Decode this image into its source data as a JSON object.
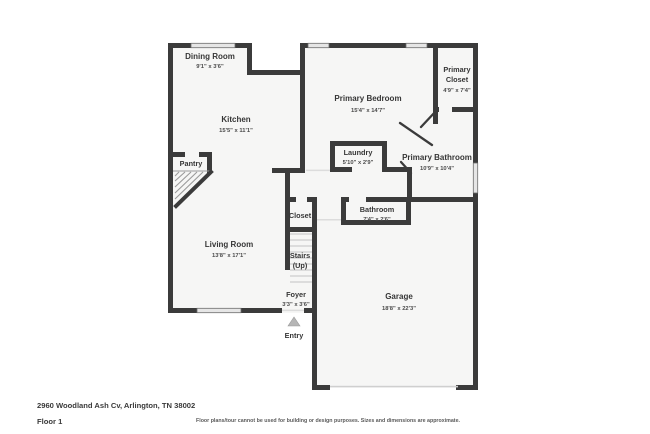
{
  "floor_plan": {
    "address": "2960 Woodland Ash Cv, Arlington, TN 38002",
    "floor_label": "Floor 1",
    "disclaimer": "Floor plans/tour cannot be used for building or design purposes. Sizes and dimensions are approximate.",
    "entry_label": "Entry",
    "colors": {
      "wall": "#3b3b3b",
      "room_fill": "#f6f6f5",
      "window": "#e6e6e6",
      "garage_door": "#cfcfcf",
      "stair_tread": "#c3c3c3",
      "entry_arrow": "#b5b5b5",
      "room_text": "#363636",
      "dims_text": "#4a4a4a",
      "disclaimer_text": "#5a5a5a"
    },
    "rooms": {
      "dining": {
        "name": "Dining Room",
        "dims": "9'1\" x 3'6\""
      },
      "kitchen": {
        "name": "Kitchen",
        "dims": "15'5\" x 11'1\""
      },
      "pantry": {
        "name": "Pantry"
      },
      "living": {
        "name": "Living Room",
        "dims": "13'8\" x 17'1\""
      },
      "closet": {
        "name": "Closet"
      },
      "stairs": {
        "name": "Stairs",
        "sub": "(Up)"
      },
      "foyer": {
        "name": "Foyer",
        "dims": "3'3\" x 3'6\""
      },
      "primary_bedroom": {
        "name": "Primary Bedroom",
        "dims": "15'4\" x 14'7\""
      },
      "primary_closet": {
        "name_line1": "Primary",
        "name_line2": "Closet",
        "dims": "4'9\" x 7'4\""
      },
      "laundry": {
        "name": "Laundry",
        "dims": "5'10\" x 2'9\""
      },
      "primary_bathroom": {
        "name": "Primary Bathroom",
        "dims": "10'9\" x 10'4\""
      },
      "bathroom": {
        "name": "Bathroom",
        "dims": "7'4\" x 2'6\""
      },
      "garage": {
        "name": "Garage",
        "dims": "18'8\" x 22'3\""
      }
    }
  }
}
